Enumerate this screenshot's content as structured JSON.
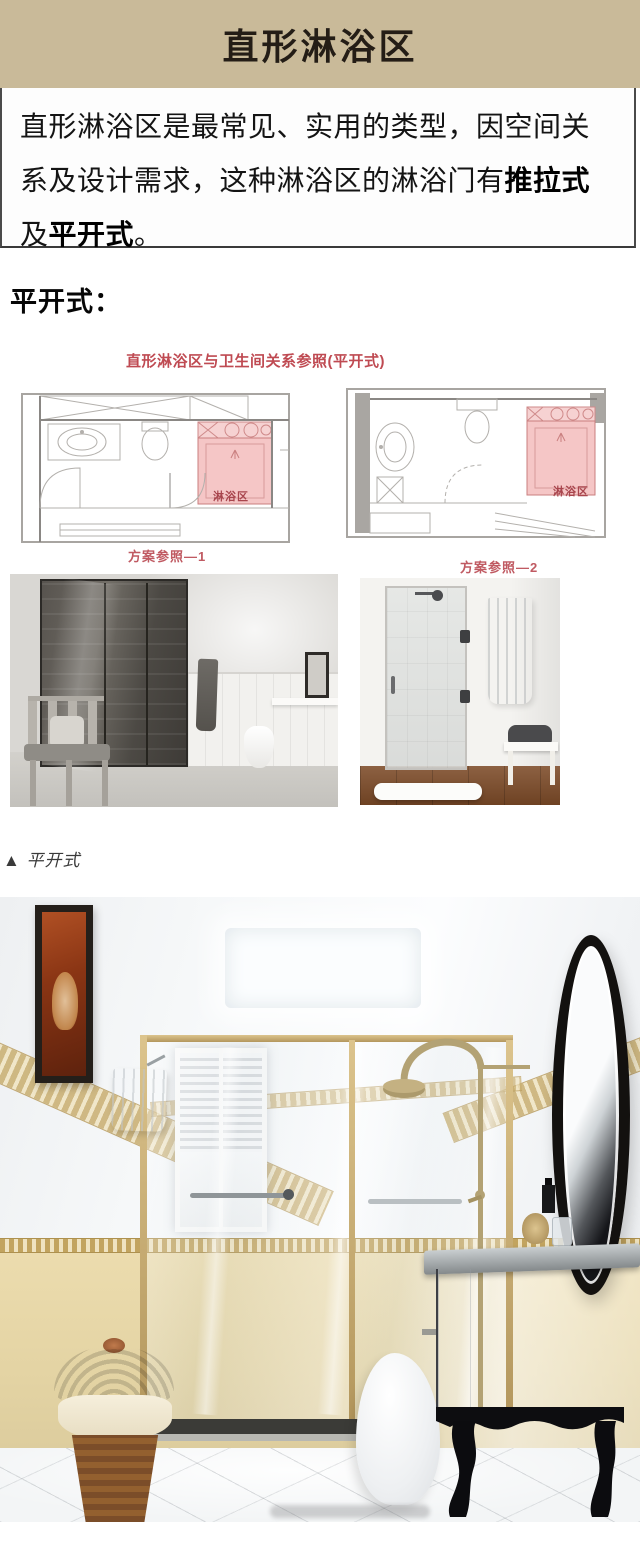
{
  "colors": {
    "header_bg": "#c9ba99",
    "accent_red": "#bf4a52",
    "plan_pink": "#f5c6c6",
    "caption_red": "#c05a62"
  },
  "header": {
    "title": "直形淋浴区"
  },
  "intro": {
    "part1": "直形淋浴区是最常见、实用的类型，因空间关系及设计需求，这种淋浴区的淋浴门有",
    "bold1": "推拉式",
    "part2": "及",
    "bold2": "平开式",
    "part3": "。"
  },
  "sections": {
    "swing_heading": "平开式："
  },
  "plans": {
    "title": "直形淋浴区与卫生间关系参照(平开式)",
    "shower_area_label": "淋浴区",
    "caption_plan1": "方案参照—1",
    "caption_plan2": "方案参照—2"
  },
  "photos": {
    "caption": "▲ 平开式"
  }
}
